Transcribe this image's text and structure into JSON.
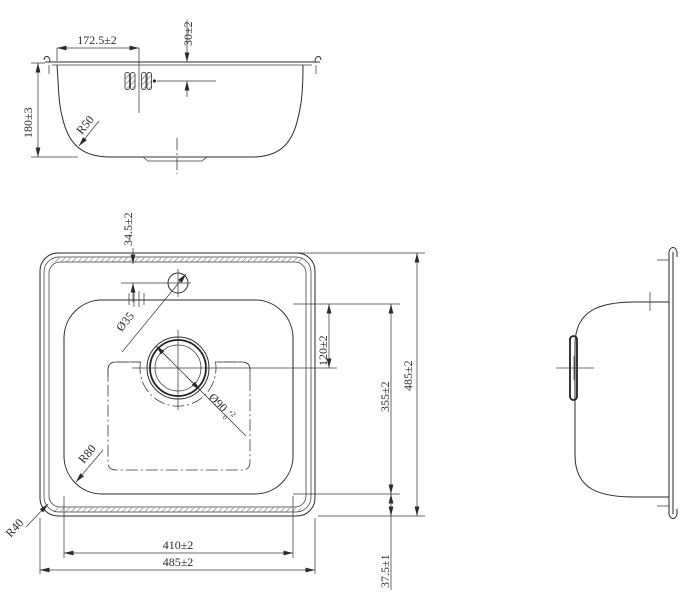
{
  "drawing": {
    "background_color": "#ffffff",
    "line_color": "#2a2a2a",
    "views": {
      "front_view": {
        "dims": {
          "stud_offset_x": "172.5±2",
          "stud_offset_y": "30±2",
          "bowl_depth": "180±3",
          "bottom_radius": "R50"
        }
      },
      "plan_view": {
        "dims": {
          "faucet_offset": "34.5±2",
          "faucet_hole_dia": "Ø35",
          "drain_dia": "Ø90",
          "drain_dia_tol_upper": "+2",
          "drain_dia_tol_lower": "0",
          "drain_center_offset": "120±2",
          "bowl_length": "355±2",
          "overall_length": "485±2",
          "bowl_width": "410±2",
          "overall_width": "485±2",
          "rim_width": "37.5±1",
          "bowl_corner_radius": "R80",
          "outer_corner_radius": "R40"
        }
      },
      "side_view": {}
    }
  }
}
